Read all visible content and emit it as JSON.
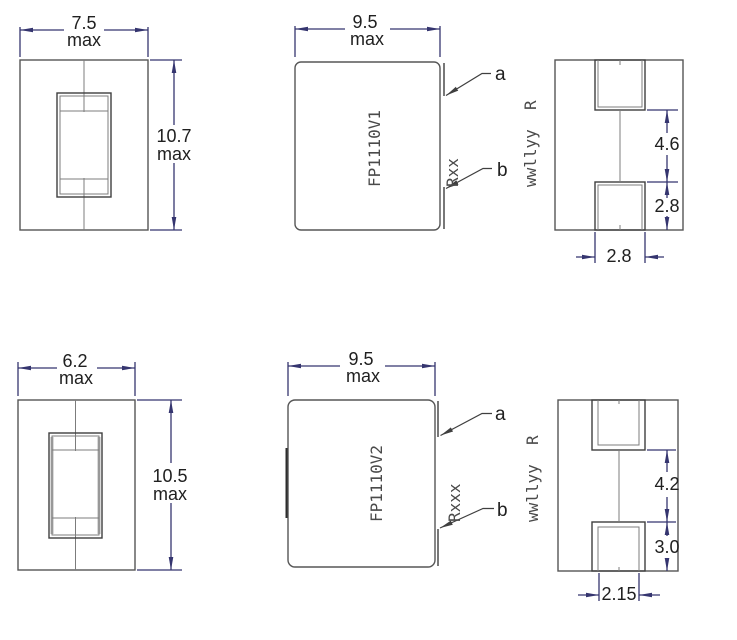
{
  "colors": {
    "outline": "#565656",
    "dimension": "#35356f",
    "dim_text": "#202020",
    "marking_text": "#4a4a4a"
  },
  "v1": {
    "front": {
      "width_value": "7.5",
      "width_qual": "max",
      "height_value": "10.7",
      "height_qual": "max"
    },
    "top": {
      "width_value": "9.5",
      "width_qual": "max",
      "marking": [
        "FP1110V1",
        "Rxx",
        "wwllyy  R"
      ],
      "terminal_a_label": "a",
      "terminal_b_label": "b"
    },
    "side": {
      "center_gap": "4.6",
      "terminal_height": "2.8",
      "terminal_width": "2.8"
    }
  },
  "v2": {
    "front": {
      "width_value": "6.2",
      "width_qual": "max",
      "height_value": "10.5",
      "height_qual": "max"
    },
    "top": {
      "width_value": "9.5",
      "width_qual": "max",
      "marking": [
        "FP1110V2",
        "Rxxx",
        "wwllyy  R"
      ],
      "terminal_a_label": "a",
      "terminal_b_label": "b"
    },
    "side": {
      "center_gap": "4.2",
      "terminal_height": "3.0",
      "terminal_width": "2.15"
    }
  }
}
